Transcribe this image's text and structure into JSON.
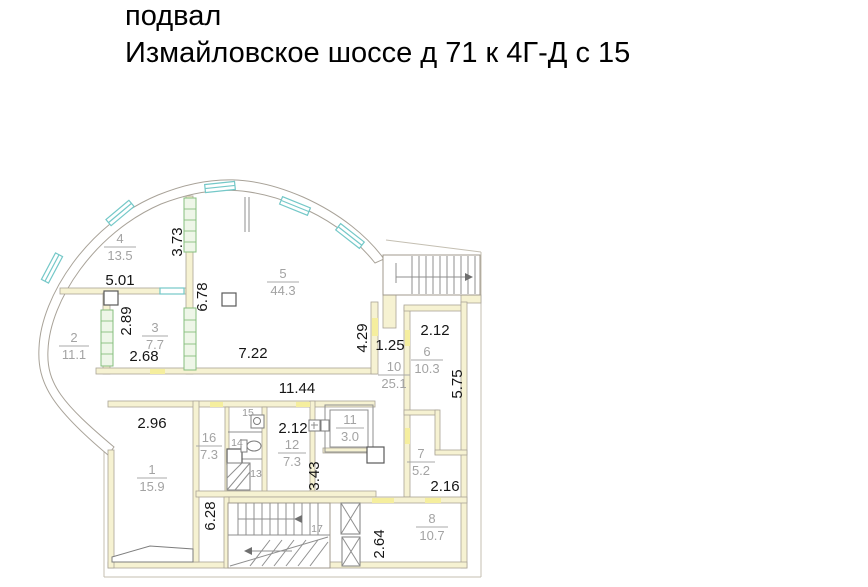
{
  "title": {
    "line1": "подвал",
    "line2": "Измайловское шоссе д 71 к 4Г-Д с 15"
  },
  "plan": {
    "floor": "basement",
    "rooms": {
      "r1": {
        "number": "1",
        "area": "15.9"
      },
      "r2": {
        "number": "2",
        "area": "11.1"
      },
      "r3": {
        "number": "3",
        "area": "7.7"
      },
      "r4": {
        "number": "4",
        "area": "13.5"
      },
      "r5": {
        "number": "5",
        "area": "44.3"
      },
      "r6": {
        "number": "6",
        "area": "10.3"
      },
      "r7": {
        "number": "7",
        "area": "5.2"
      },
      "r8": {
        "number": "8",
        "area": "10.7"
      },
      "r10": {
        "number": "10",
        "area": "25.1"
      },
      "r11": {
        "number": "11",
        "area": "3.0"
      },
      "r12": {
        "number": "12",
        "area": "7.3"
      },
      "r13": {
        "number": "13"
      },
      "r14": {
        "number": "14"
      },
      "r15": {
        "number": "15"
      },
      "r16": {
        "number": "16",
        "area": "7.3"
      },
      "r17": {
        "number": "17"
      }
    },
    "dims": [
      "5.01",
      "3.73",
      "2.89",
      "2.68",
      "6.78",
      "7.22",
      "11.44",
      "4.29",
      "1.25",
      "2.12",
      "5.75",
      "2.96",
      "2.12",
      "3.43",
      "6.28",
      "2.64",
      "2.16"
    ],
    "colors": {
      "wall_fill": "#f6f2d2",
      "door_highlight": "#f5ee9e",
      "window_accent": "#74c8c8",
      "partition_green": "#86bf7e",
      "dimension_text": "#151515",
      "room_label_gray": "#a3a3a3"
    }
  }
}
